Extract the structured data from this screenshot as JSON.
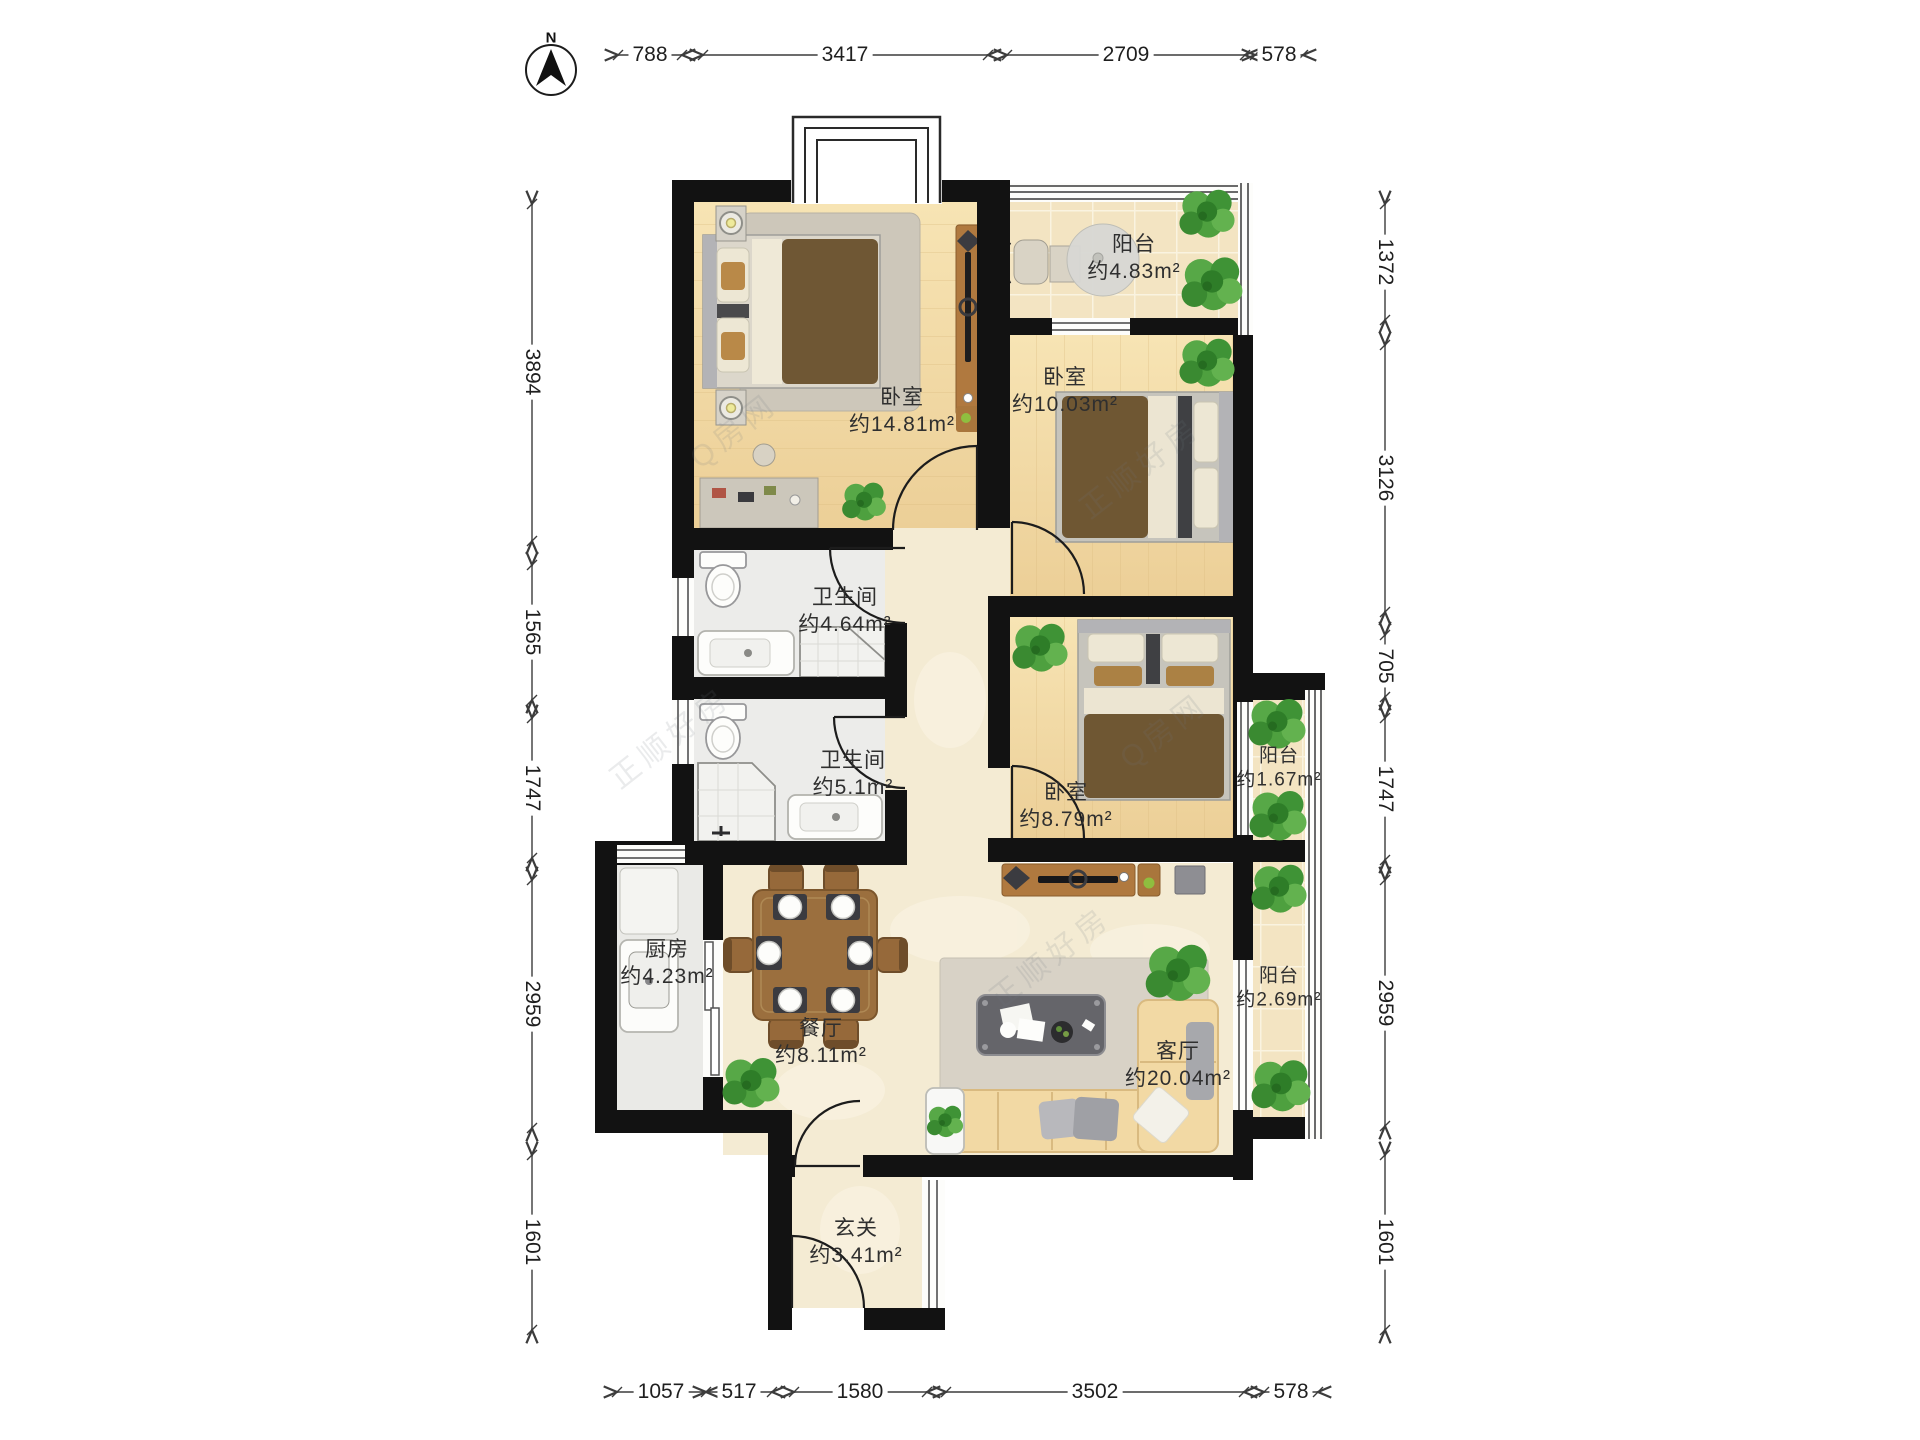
{
  "compass": {
    "north_label": "N"
  },
  "watermark": {
    "brand": "正顺好房",
    "site": "Q房网"
  },
  "rooms": [
    {
      "id": "bedroom-master",
      "name": "卧室",
      "area": "约14.81m²"
    },
    {
      "id": "balcony-north",
      "name": "阳台",
      "area": "约4.83m²"
    },
    {
      "id": "bedroom-middle",
      "name": "卧室",
      "area": "约10.03m²"
    },
    {
      "id": "bathroom-1",
      "name": "卫生间",
      "area": "约4.64m²"
    },
    {
      "id": "bathroom-2",
      "name": "卫生间",
      "area": "约5.1m²"
    },
    {
      "id": "bedroom-small",
      "name": "卧室",
      "area": "约8.79m²"
    },
    {
      "id": "balcony-small",
      "name": "阳台",
      "area": "约1.67m²"
    },
    {
      "id": "kitchen",
      "name": "厨房",
      "area": "约4.23m²"
    },
    {
      "id": "dining",
      "name": "餐厅",
      "area": "约8.11m²"
    },
    {
      "id": "living",
      "name": "客厅",
      "area": "约20.04m²"
    },
    {
      "id": "balcony-east",
      "name": "阳台",
      "area": "约2.69m²"
    },
    {
      "id": "foyer",
      "name": "玄关",
      "area": "约3.41m²"
    }
  ],
  "dimensions": {
    "top": [
      "788",
      "3417",
      "2709",
      "578"
    ],
    "bottom": [
      "1057",
      "517",
      "1580",
      "3502",
      "578"
    ],
    "left": [
      "3894",
      "1565",
      "1747",
      "2959",
      "1601"
    ],
    "right": [
      "1372",
      "3126",
      "705",
      "1747",
      "2959",
      "1601"
    ]
  }
}
